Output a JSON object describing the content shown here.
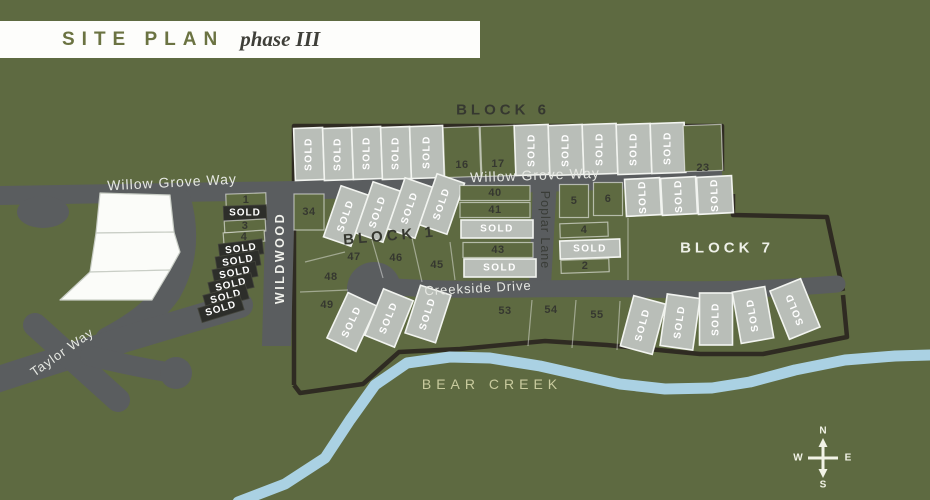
{
  "title": {
    "site_plan": "SITE PLAN",
    "phase": "phase III"
  },
  "compass": {
    "n": "N",
    "s": "S",
    "e": "E",
    "w": "W"
  },
  "colors": {
    "background": "#5e6a41",
    "road": "#5a5d5f",
    "lot_sold_light": "#b9beb8",
    "lot_sold_dark": "#2d2e2a",
    "phase_boundary": "#2f2b22",
    "creek": "#aad1e3",
    "white_lot": "#fbfcf9",
    "title_green": "#6b7342",
    "title_dark": "#3f3f39"
  },
  "blocks": [
    {
      "id": "block-6",
      "label": "BLOCK 6",
      "cx": 503,
      "cy": 110,
      "rot": 0,
      "cls": "blockDark"
    },
    {
      "id": "block-1",
      "label": "BLOCK 1",
      "cx": 390,
      "cy": 236,
      "rot": -5,
      "cls": "blockDark"
    },
    {
      "id": "block-7",
      "label": "BLOCK 7",
      "cx": 727,
      "cy": 248,
      "rot": 0,
      "cls": "blockLight"
    }
  ],
  "streets": [
    {
      "id": "willow-grove-way-west",
      "label": "Willow Grove Way",
      "cx": 172,
      "cy": 182,
      "rot": -3,
      "cls": "stWhite"
    },
    {
      "id": "willow-grove-way",
      "label": "Willow Grove Way",
      "cx": 535,
      "cy": 175,
      "rot": -2,
      "cls": "stWhite"
    },
    {
      "id": "wildwood",
      "label": "WILDWOOD",
      "cx": 280,
      "cy": 258,
      "rot": -90,
      "cls": "stWildwood"
    },
    {
      "id": "poplar-lane",
      "label": "Poplar Lane",
      "cx": 545,
      "cy": 230,
      "rot": 90,
      "cls": "stPoplar"
    },
    {
      "id": "creekside-drive",
      "label": "Creekside Drive",
      "cx": 478,
      "cy": 288,
      "rot": -3,
      "cls": "stWhite2"
    },
    {
      "id": "taylor-way",
      "label": "Taylor Way",
      "cx": 62,
      "cy": 352,
      "rot": -35,
      "cls": "stWhite2"
    },
    {
      "id": "bear-creek",
      "label": "BEAR CREEK",
      "cx": 492,
      "cy": 384,
      "rot": 0,
      "cls": "stCreek"
    }
  ],
  "lots": [
    {
      "label": "SOLD",
      "status": "sold_light",
      "cx": 309,
      "cy": 154,
      "w": 29,
      "h": 52,
      "rot": -2,
      "tRot": -90
    },
    {
      "label": "SOLD",
      "status": "sold_light",
      "cx": 338,
      "cy": 154,
      "w": 29,
      "h": 52,
      "rot": -2,
      "tRot": -90
    },
    {
      "label": "SOLD",
      "status": "sold_light",
      "cx": 367,
      "cy": 153,
      "w": 29,
      "h": 52,
      "rot": -2,
      "tRot": -90
    },
    {
      "label": "SOLD",
      "status": "sold_light",
      "cx": 396,
      "cy": 153,
      "w": 29,
      "h": 52,
      "rot": -2,
      "tRot": -90
    },
    {
      "label": "SOLD",
      "status": "sold_light",
      "cx": 427,
      "cy": 152,
      "w": 33,
      "h": 52,
      "rot": -2,
      "tRot": -90
    },
    {
      "label": "16",
      "status": "open",
      "cx": 462,
      "cy": 152,
      "w": 36,
      "h": 50,
      "rot": -2,
      "tDy": 13,
      "tSize": 12
    },
    {
      "label": "17",
      "status": "open",
      "cx": 498,
      "cy": 151,
      "w": 34,
      "h": 50,
      "rot": -2,
      "tDy": 13,
      "tSize": 12
    },
    {
      "label": "SOLD",
      "status": "sold_light",
      "cx": 532,
      "cy": 150,
      "w": 34,
      "h": 50,
      "rot": -2,
      "tRot": -90
    },
    {
      "label": "SOLD",
      "status": "sold_light",
      "cx": 566,
      "cy": 150,
      "w": 34,
      "h": 50,
      "rot": -2,
      "tRot": -90
    },
    {
      "label": "SOLD",
      "status": "sold_light",
      "cx": 600,
      "cy": 149,
      "w": 34,
      "h": 50,
      "rot": -2,
      "tRot": -90
    },
    {
      "label": "SOLD",
      "status": "sold_light",
      "cx": 634,
      "cy": 149,
      "w": 34,
      "h": 50,
      "rot": -2,
      "tRot": -90
    },
    {
      "label": "SOLD",
      "status": "sold_light",
      "cx": 668,
      "cy": 148,
      "w": 34,
      "h": 50,
      "rot": -2,
      "tRot": -90
    },
    {
      "label": "23",
      "status": "open",
      "cx": 703,
      "cy": 148,
      "w": 38,
      "h": 46,
      "rot": -2,
      "tDy": 20,
      "tSize": 12
    },
    {
      "label": "SOLD",
      "status": "sold_light",
      "cx": 643,
      "cy": 197,
      "w": 35,
      "h": 37,
      "rot": -3,
      "tRot": -92
    },
    {
      "label": "SOLD",
      "status": "sold_light",
      "cx": 679,
      "cy": 196,
      "w": 35,
      "h": 37,
      "rot": -3,
      "tRot": -92
    },
    {
      "label": "SOLD",
      "status": "sold_light",
      "cx": 715,
      "cy": 195,
      "w": 35,
      "h": 37,
      "rot": -3,
      "tRot": -92
    },
    {
      "label": "1",
      "status": "open",
      "cx": 246,
      "cy": 200,
      "w": 40,
      "h": 13,
      "rot": -2,
      "tSize": 9
    },
    {
      "label": "SOLD",
      "status": "sold_dark",
      "cx": 245,
      "cy": 213,
      "w": 43,
      "h": 15,
      "rot": -2
    },
    {
      "label": "3",
      "status": "open",
      "cx": 245,
      "cy": 226,
      "w": 41,
      "h": 12,
      "rot": -3,
      "tSize": 9
    },
    {
      "label": "4",
      "status": "open",
      "cx": 244,
      "cy": 237,
      "w": 41,
      "h": 11,
      "rot": -4,
      "tSize": 9
    },
    {
      "label": "SOLD",
      "status": "sold_dark",
      "cx": 241,
      "cy": 249,
      "w": 44,
      "h": 15,
      "rot": -7,
      "tRot": -7
    },
    {
      "label": "SOLD",
      "status": "sold_dark",
      "cx": 238,
      "cy": 261,
      "w": 44,
      "h": 15,
      "rot": -9,
      "tRot": -9
    },
    {
      "label": "SOLD",
      "status": "sold_dark",
      "cx": 235,
      "cy": 273,
      "w": 44,
      "h": 15,
      "rot": -11,
      "tRot": -11
    },
    {
      "label": "SOLD",
      "status": "sold_dark",
      "cx": 231,
      "cy": 285,
      "w": 44,
      "h": 15,
      "rot": -13,
      "tRot": -13
    },
    {
      "label": "SOLD",
      "status": "sold_dark",
      "cx": 226,
      "cy": 297,
      "w": 44,
      "h": 15,
      "rot": -15,
      "tRot": -15
    },
    {
      "label": "SOLD",
      "status": "sold_dark",
      "cx": 221,
      "cy": 309,
      "w": 44,
      "h": 15,
      "rot": -17,
      "tRot": -17
    },
    {
      "label": "34",
      "status": "open",
      "cx": 309,
      "cy": 212,
      "w": 30,
      "h": 36,
      "rot": 0,
      "tSize": 12
    },
    {
      "label": "SOLD",
      "status": "sold_light",
      "cx": 346,
      "cy": 216,
      "w": 29,
      "h": 54,
      "rot": 19,
      "tRot": -71
    },
    {
      "label": "SOLD",
      "status": "sold_light",
      "cx": 378,
      "cy": 212,
      "w": 29,
      "h": 54,
      "rot": 19,
      "tRot": -71
    },
    {
      "label": "SOLD",
      "status": "sold_light",
      "cx": 410,
      "cy": 208,
      "w": 29,
      "h": 54,
      "rot": 19,
      "tRot": -71
    },
    {
      "label": "SOLD",
      "status": "sold_light",
      "cx": 442,
      "cy": 204,
      "w": 29,
      "h": 54,
      "rot": 19,
      "tRot": -71
    },
    {
      "label": "47",
      "status": "open",
      "cx": 354,
      "cy": 257,
      "tSize": 13
    },
    {
      "label": "46",
      "status": "open",
      "cx": 396,
      "cy": 258,
      "tSize": 13
    },
    {
      "label": "45",
      "status": "open",
      "cx": 437,
      "cy": 265,
      "tSize": 13
    },
    {
      "label": "48",
      "status": "open",
      "cx": 331,
      "cy": 277,
      "tSize": 13
    },
    {
      "label": "49",
      "status": "open",
      "cx": 327,
      "cy": 305,
      "tSize": 12
    },
    {
      "label": "40",
      "status": "open",
      "cx": 495,
      "cy": 193,
      "w": 70,
      "h": 15,
      "rot": 0,
      "tSize": 10
    },
    {
      "label": "41",
      "status": "open",
      "cx": 495,
      "cy": 210,
      "w": 70,
      "h": 15,
      "rot": 0,
      "tSize": 10
    },
    {
      "label": "SOLD",
      "status": "sold_light",
      "cx": 497,
      "cy": 229,
      "w": 72,
      "h": 18,
      "rot": 0,
      "tRot": 0
    },
    {
      "label": "43",
      "status": "open",
      "cx": 498,
      "cy": 250,
      "w": 70,
      "h": 15,
      "rot": 0,
      "tSize": 10
    },
    {
      "label": "SOLD",
      "status": "sold_light",
      "cx": 500,
      "cy": 268,
      "w": 72,
      "h": 18,
      "rot": 0,
      "tRot": 0
    },
    {
      "label": "5",
      "status": "open",
      "cx": 574,
      "cy": 201,
      "w": 29,
      "h": 33,
      "rot": 0,
      "tSize": 11
    },
    {
      "label": "6",
      "status": "open",
      "cx": 608,
      "cy": 199,
      "w": 29,
      "h": 33,
      "rot": 0,
      "tSize": 11
    },
    {
      "label": "4",
      "status": "open",
      "cx": 584,
      "cy": 230,
      "w": 48,
      "h": 14,
      "rot": -2,
      "tSize": 10
    },
    {
      "label": "SOLD",
      "status": "sold_light",
      "cx": 590,
      "cy": 249,
      "w": 60,
      "h": 18,
      "rot": -2,
      "tRot": 0
    },
    {
      "label": "2",
      "status": "open",
      "cx": 585,
      "cy": 266,
      "w": 48,
      "h": 13,
      "rot": -2,
      "tSize": 10
    },
    {
      "label": "SOLD",
      "status": "sold_light",
      "cx": 352,
      "cy": 322,
      "w": 32,
      "h": 50,
      "rot": 25,
      "tRot": -65
    },
    {
      "label": "SOLD",
      "status": "sold_light",
      "cx": 389,
      "cy": 318,
      "w": 32,
      "h": 50,
      "rot": 22,
      "tRot": -68
    },
    {
      "label": "SOLD",
      "status": "sold_light",
      "cx": 428,
      "cy": 314,
      "w": 32,
      "h": 50,
      "rot": 18,
      "tRot": -72
    },
    {
      "label": "53",
      "status": "open",
      "cx": 505,
      "cy": 311,
      "tSize": 12
    },
    {
      "label": "54",
      "status": "open",
      "cx": 551,
      "cy": 310,
      "tSize": 12
    },
    {
      "label": "55",
      "status": "open",
      "cx": 597,
      "cy": 315,
      "tSize": 12
    },
    {
      "label": "SOLD",
      "status": "sold_light",
      "cx": 643,
      "cy": 325,
      "w": 33,
      "h": 52,
      "rot": 15,
      "tRot": -75
    },
    {
      "label": "SOLD",
      "status": "sold_light",
      "cx": 680,
      "cy": 322,
      "w": 33,
      "h": 52,
      "rot": 8,
      "tRot": -82
    },
    {
      "label": "SOLD",
      "status": "sold_light",
      "cx": 716,
      "cy": 319,
      "w": 33,
      "h": 52,
      "rot": 0,
      "tRot": -90
    },
    {
      "label": "SOLD",
      "status": "sold_light",
      "cx": 753,
      "cy": 315,
      "w": 33,
      "h": 52,
      "rot": -10,
      "tRot": -100
    },
    {
      "label": "SOLD",
      "status": "sold_light",
      "cx": 795,
      "cy": 309,
      "w": 33,
      "h": 52,
      "rot": -22,
      "tRot": -112
    }
  ]
}
